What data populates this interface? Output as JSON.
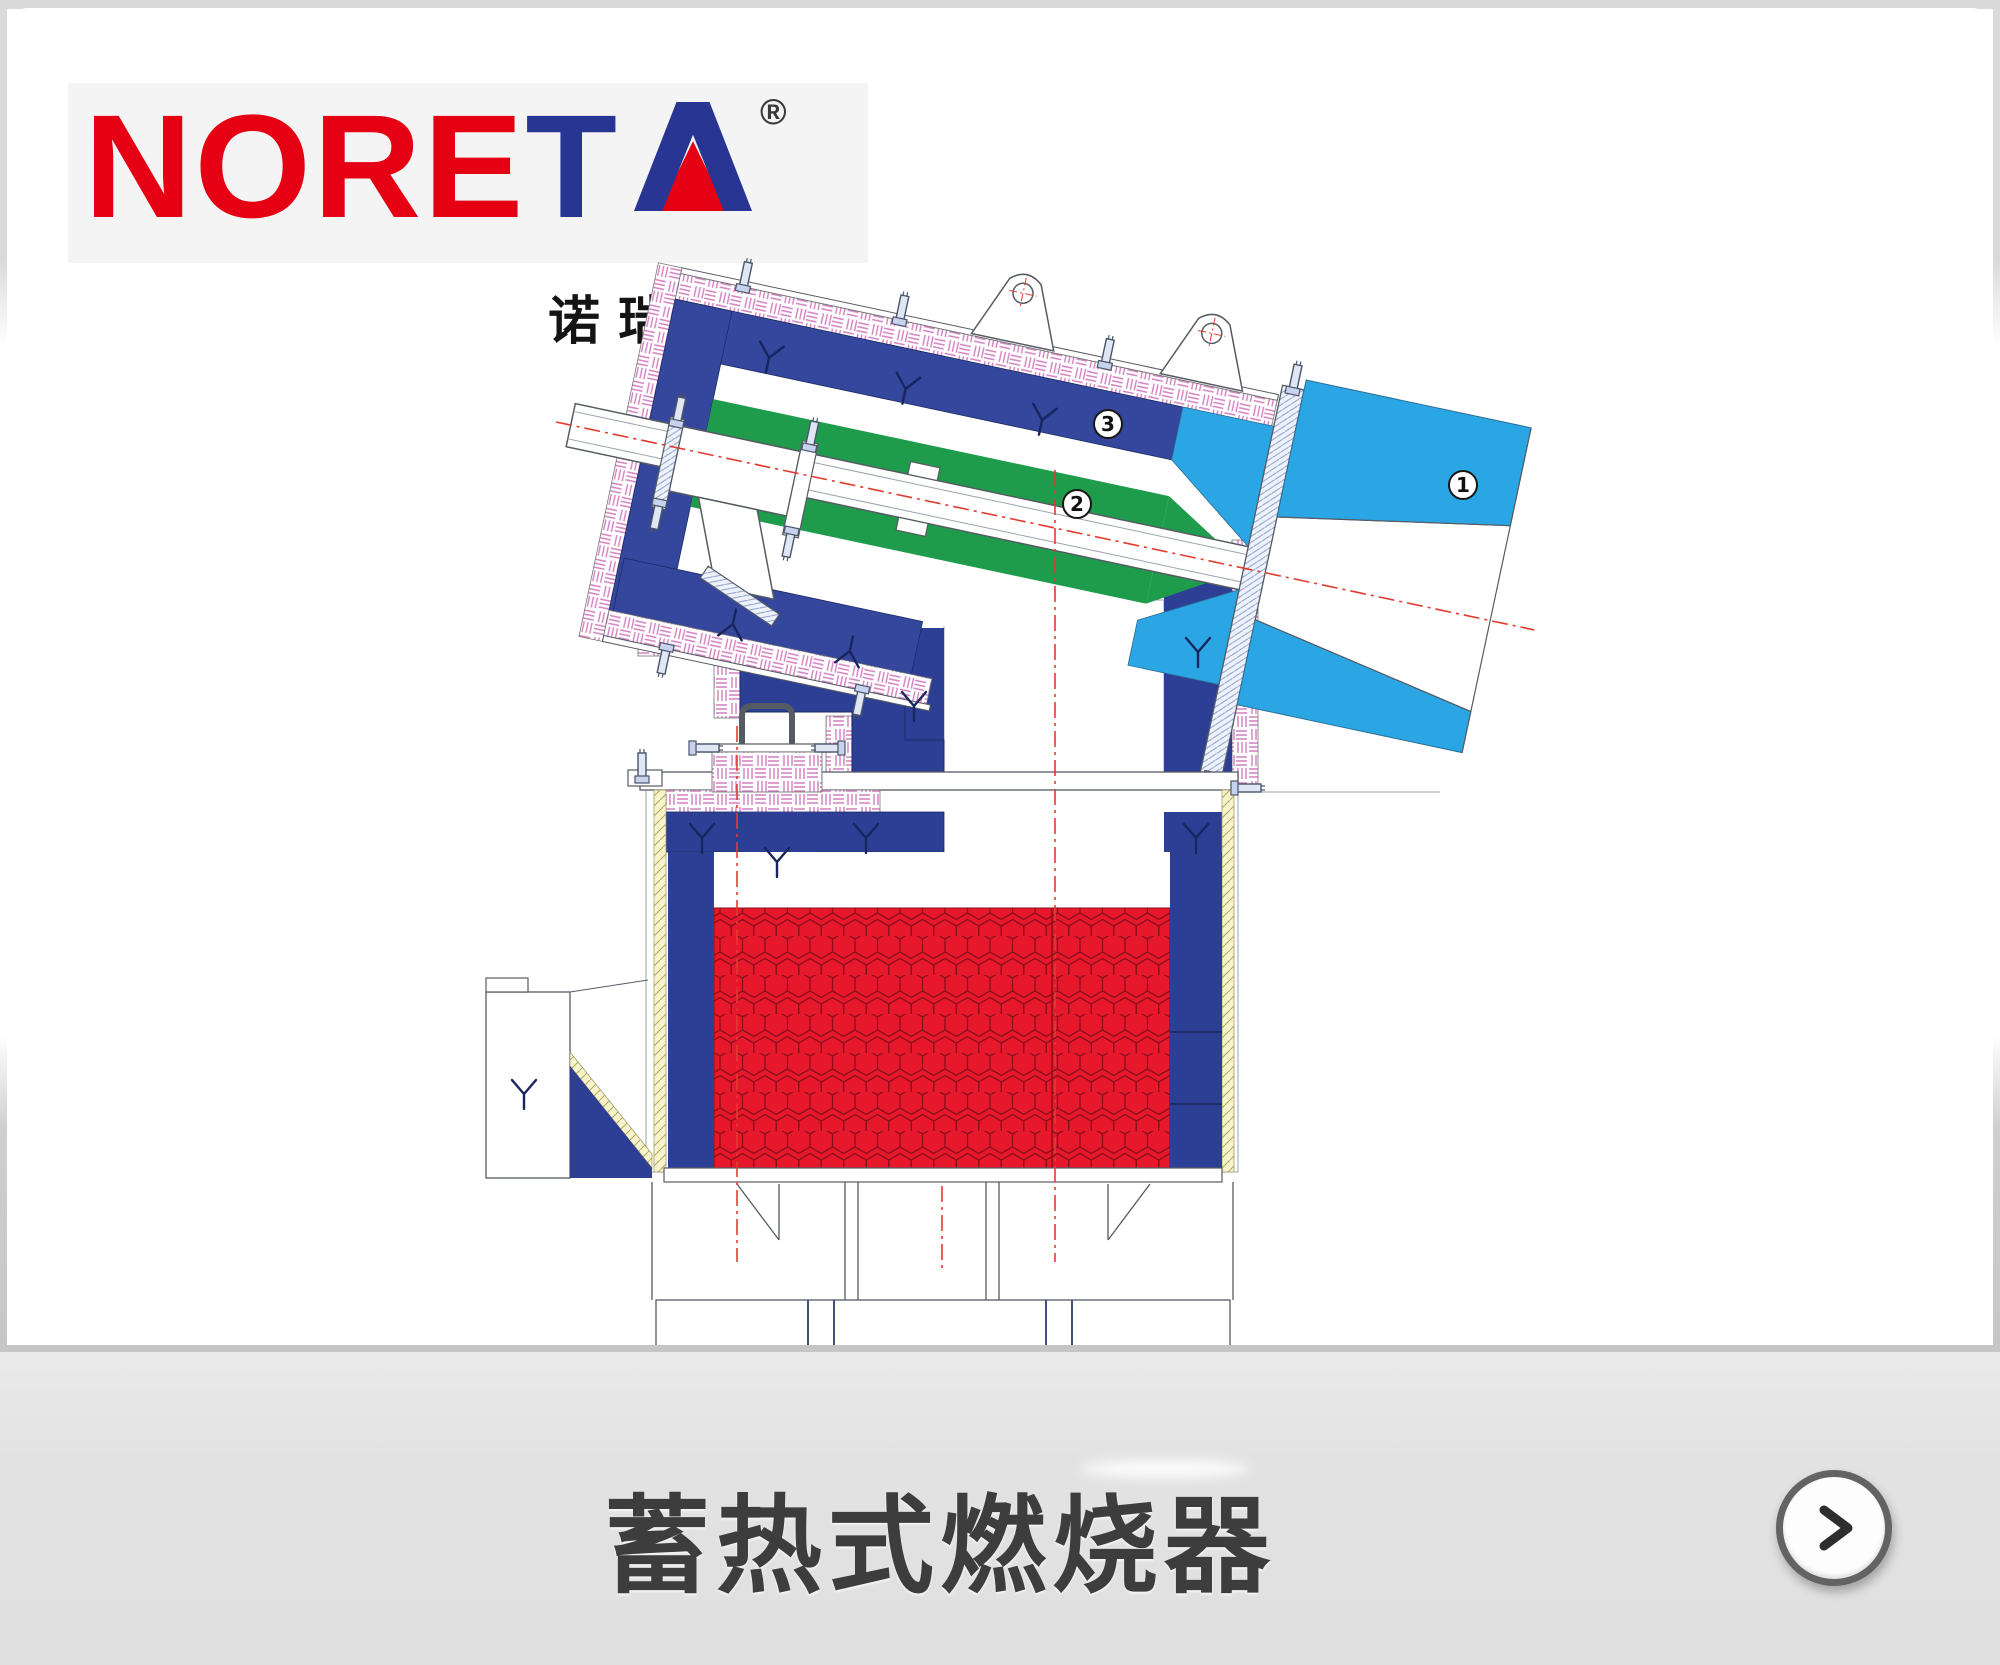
{
  "brand": {
    "logo_word": "NORETA",
    "letters": [
      {
        "ch": "N",
        "color": "#e60013"
      },
      {
        "ch": "O",
        "color": "#e60013"
      },
      {
        "ch": "R",
        "color": "#e60013"
      },
      {
        "ch": "E",
        "color": "#e60013"
      },
      {
        "ch": "T",
        "color": "#283593"
      }
    ],
    "letter_a": "A",
    "registered_mark": "®",
    "chinese_name": "诺瑞达"
  },
  "diagram": {
    "type": "technical-drawing",
    "subject": "regenerative burner cross-section",
    "callouts": [
      {
        "number": "1",
        "x": 1463,
        "y": 485
      },
      {
        "number": "2",
        "x": 1077,
        "y": 504
      },
      {
        "number": "3",
        "x": 1108,
        "y": 424
      }
    ]
  },
  "footer": {
    "title": "蓄热式燃烧器",
    "next_icon": "chevron-right-icon"
  },
  "palette": {
    "brand-red": "#e60013",
    "brand-navy": "#283593",
    "navy": "#2c3f94",
    "navy2": "#35479d",
    "green": "#1e9b4b",
    "cyan": "#2aa6e4",
    "hex-red": "#e7182b",
    "hex-line": "#8a0f1c",
    "pink": "#d47ec0",
    "line": "#565b63",
    "centerline-red": "#e23b30",
    "edge": "#dadada"
  }
}
